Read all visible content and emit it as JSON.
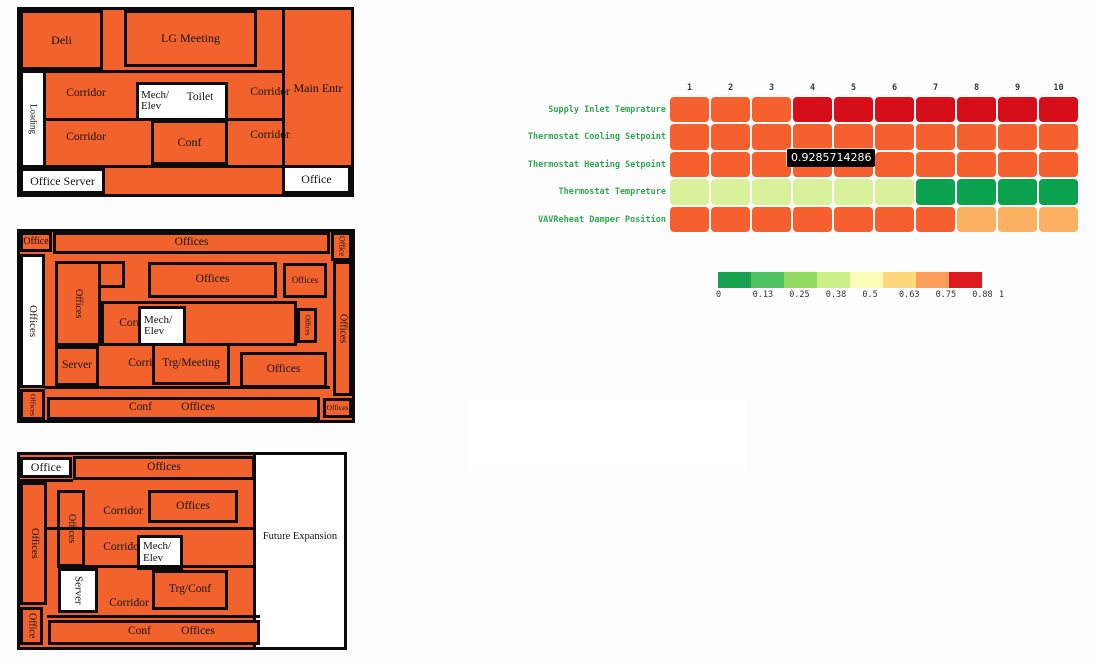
{
  "page": {
    "background": "#fdfdfd"
  },
  "chart_data": {
    "type": "heatmap",
    "title": "",
    "x": [
      1,
      2,
      3,
      4,
      5,
      6,
      7,
      8,
      9,
      10
    ],
    "rows": [
      "Supply Inlet Temprature",
      "Thermostat Cooling Setpoint",
      "Thermostat Heating Setpoint",
      "Thermostat Tempreture",
      "VAVReheat Damper Position"
    ],
    "values": [
      [
        0.93,
        0.93,
        0.93,
        1,
        1,
        1,
        1,
        1,
        1,
        1
      ],
      [
        0.93,
        0.93,
        0.93,
        0.93,
        0.93,
        0.93,
        0.93,
        0.93,
        0.93,
        0.93
      ],
      [
        0.9285714286,
        0.9285714286,
        0.9285714286,
        0.9285714286,
        0.9285714286,
        0.9285714286,
        0.9285714286,
        0.9285714286,
        0.9285714286,
        0.9285714286
      ],
      [
        0.3,
        0.3,
        0.3,
        0.3,
        0.3,
        0.3,
        0.05,
        0.05,
        0.05,
        0.05
      ],
      [
        0.93,
        0.93,
        0.93,
        0.93,
        0.93,
        0.93,
        0.93,
        0.75,
        0.75,
        0.75
      ]
    ],
    "zmin": 0,
    "zmax": 1,
    "colorscale": "RdYlGn reversed",
    "colorbar_ticks": [
      0,
      0.13,
      0.25,
      0.38,
      0.5,
      0.63,
      0.75,
      0.88,
      1
    ],
    "hovered_value": "0.9285714286",
    "legend_position": "below"
  },
  "heatmap": {
    "columns": [
      "1",
      "2",
      "3",
      "4",
      "5",
      "6",
      "7",
      "8",
      "9",
      "10"
    ],
    "rows": [
      {
        "label": "Supply Inlet Temprature",
        "cells": [
          "O",
          "O",
          "O",
          "R",
          "R",
          "R",
          "R",
          "R",
          "R",
          "R"
        ]
      },
      {
        "label": "Thermostat Cooling Setpoint",
        "cells": [
          "O",
          "O",
          "O",
          "O",
          "O",
          "O",
          "O",
          "O",
          "O",
          "O"
        ]
      },
      {
        "label": "Thermostat Heating Setpoint",
        "cells": [
          "O",
          "O",
          "O",
          "O",
          "O",
          "O",
          "O",
          "O",
          "O",
          "O"
        ]
      },
      {
        "label": "Thermostat Tempreture",
        "cells": [
          "LG",
          "LG",
          "LG",
          "LG",
          "LG",
          "LG",
          "DG",
          "DG",
          "DG",
          "DG"
        ]
      },
      {
        "label": "VAVReheat Damper Position",
        "cells": [
          "O",
          "O",
          "O",
          "O",
          "O",
          "O",
          "O",
          "LO",
          "LO",
          "LO"
        ]
      }
    ],
    "palette": {
      "O": "#F6602F",
      "R": "#D60E1A",
      "LG": "#D9F19B",
      "DG": "#0AA24F",
      "LO": "#FBB161"
    },
    "tooltip": {
      "text": "0.9285714286",
      "bg": "#000000",
      "fg": "#ffffff"
    },
    "label_color": "#2FA84F"
  },
  "legend": {
    "colors": [
      "#17A050",
      "#4FC263",
      "#96DB61",
      "#CDF189",
      "#FAFDB7",
      "#FDD87B",
      "#FB9C58",
      "#DC1A20"
    ],
    "ticks": [
      "0",
      "0.13",
      "0.25",
      "0.38",
      "0.5",
      "0.63",
      "0.75",
      "0.88",
      "1"
    ]
  },
  "floorplans": [
    {
      "name": "floor-1",
      "x": 17,
      "y": 7,
      "w": 337,
      "h": 190,
      "elements": [
        {
          "id": "wall-main-entr",
          "type": "wall",
          "x": 262,
          "y": 0,
          "w": 3,
          "h": 184
        },
        {
          "id": "wall-h1",
          "type": "wall",
          "x": 0,
          "y": 60,
          "w": 265,
          "h": 3
        },
        {
          "id": "wall-h2",
          "type": "wall",
          "x": 23,
          "y": 108,
          "w": 242,
          "h": 3
        },
        {
          "id": "wall-h3",
          "type": "wall",
          "x": 23,
          "y": 155,
          "w": 242,
          "h": 3
        },
        {
          "id": "room-deli",
          "type": "room",
          "label": "Deli",
          "x": 0,
          "y": 0,
          "w": 83,
          "h": 60,
          "fs": 12
        },
        {
          "id": "room-lg-meeting",
          "type": "room",
          "label": "LG Meeting",
          "x": 104,
          "y": 0,
          "w": 133,
          "h": 57,
          "fs": 12
        },
        {
          "id": "room-loading",
          "type": "white",
          "label": "Loading",
          "x": 0,
          "y": 60,
          "w": 26,
          "h": 98,
          "fs": 9,
          "vert": true
        },
        {
          "id": "room-mech-toilet",
          "type": "white",
          "label": "",
          "x": 116,
          "y": 72,
          "w": 92,
          "h": 39
        },
        {
          "id": "label-mech-elev",
          "type": "text",
          "label": "Mech/\nElev",
          "x": 118,
          "y": 75,
          "w": 40,
          "h": 32,
          "fs": 11,
          "align": "left"
        },
        {
          "id": "label-toilet",
          "type": "text",
          "label": "Toilet",
          "x": 155,
          "y": 80,
          "w": 50,
          "h": 16,
          "fs": 11.5
        },
        {
          "id": "room-conf",
          "type": "room",
          "label": "Conf",
          "x": 131,
          "y": 110,
          "w": 77,
          "h": 45,
          "fs": 12
        },
        {
          "id": "room-office-server",
          "type": "white",
          "label": "Office Server",
          "x": 0,
          "y": 158,
          "w": 85,
          "h": 26,
          "fs": 12
        },
        {
          "id": "room-office-br",
          "type": "white",
          "label": "Office",
          "x": 262,
          "y": 155,
          "w": 69,
          "h": 29,
          "fs": 12
        },
        {
          "id": "label-main-entr",
          "type": "text",
          "label": "Main Entr",
          "x": 265,
          "y": 70,
          "w": 66,
          "h": 16,
          "fs": 12
        },
        {
          "id": "label-corridor-1",
          "type": "text",
          "label": "Corridor",
          "x": 35,
          "y": 77,
          "w": 62,
          "h": 14,
          "fs": 11.5
        },
        {
          "id": "label-corridor-2",
          "type": "text",
          "label": "Corridor",
          "x": 219,
          "y": 76,
          "w": 62,
          "h": 14,
          "fs": 11.5
        },
        {
          "id": "label-corridor-3",
          "type": "text",
          "label": "Corridor",
          "x": 35,
          "y": 121,
          "w": 62,
          "h": 14,
          "fs": 11.5
        },
        {
          "id": "label-corridor-4",
          "type": "text",
          "label": "Corridor",
          "x": 219,
          "y": 119,
          "w": 62,
          "h": 14,
          "fs": 11.5
        }
      ]
    },
    {
      "name": "floor-2",
      "x": 17,
      "y": 229,
      "w": 338,
      "h": 194,
      "elements": [
        {
          "id": "wall-bottom",
          "type": "wall",
          "x": 25,
          "y": 154,
          "w": 285,
          "h": 3
        },
        {
          "id": "room-office-tl",
          "type": "room",
          "label": "Office",
          "x": 0,
          "y": 0,
          "w": 32,
          "h": 20,
          "fs": 10
        },
        {
          "id": "room-offices-top",
          "type": "room",
          "label": "Offices",
          "x": 33,
          "y": 0,
          "w": 277,
          "h": 22,
          "fs": 11.5
        },
        {
          "id": "room-office-tr",
          "type": "room",
          "label": "Office",
          "x": 311,
          "y": 0,
          "w": 21,
          "h": 29,
          "fs": 8,
          "vert": true
        },
        {
          "id": "room-offices-right",
          "type": "room",
          "label": "Offices",
          "x": 313,
          "y": 29,
          "w": 19,
          "h": 135,
          "fs": 10,
          "vert": true
        },
        {
          "id": "room-offices-left",
          "type": "white",
          "label": "Offices",
          "x": 0,
          "y": 22,
          "w": 25,
          "h": 134,
          "fs": 11,
          "vert": true
        },
        {
          "id": "room-offices-bl",
          "type": "room",
          "label": "Offices",
          "x": 0,
          "y": 157,
          "w": 25,
          "h": 31,
          "fs": 7.5,
          "vert": true
        },
        {
          "id": "room-offices-inner-top",
          "type": "room",
          "label": "",
          "x": 35,
          "y": 29,
          "w": 70,
          "h": 27
        },
        {
          "id": "room-offices-inner",
          "type": "room",
          "label": "Offices",
          "x": 35,
          "y": 29,
          "w": 46,
          "h": 85,
          "fs": 10,
          "vert": true
        },
        {
          "id": "room-corridor-block",
          "type": "room",
          "label": "",
          "x": 81,
          "y": 69,
          "w": 196,
          "h": 45
        },
        {
          "id": "label-corridor-1",
          "type": "text",
          "label": "Corridor",
          "x": 88,
          "y": 85,
          "w": 62,
          "h": 14,
          "fs": 11.5
        },
        {
          "id": "room-mech-elev",
          "type": "white",
          "label": "Mech/\nElev",
          "x": 118,
          "y": 74,
          "w": 48,
          "h": 40,
          "fs": 11,
          "align": "left"
        },
        {
          "id": "room-offices-small-mr",
          "type": "room",
          "label": "Offices",
          "x": 277,
          "y": 76,
          "w": 20,
          "h": 35,
          "fs": 7,
          "vert": true
        },
        {
          "id": "room-server",
          "type": "room",
          "label": "Server",
          "x": 35,
          "y": 114,
          "w": 44,
          "h": 40,
          "fs": 11.5
        },
        {
          "id": "label-corridor-2",
          "type": "text",
          "label": "Corridor",
          "x": 93,
          "y": 125,
          "w": 70,
          "h": 14,
          "fs": 11.5
        },
        {
          "id": "room-trg-meeting",
          "type": "room",
          "label": "Trg/Meeting",
          "x": 132,
          "y": 111,
          "w": 78,
          "h": 42,
          "fs": 11.5
        },
        {
          "id": "room-offices-cr",
          "type": "room",
          "label": "Offices",
          "x": 220,
          "y": 120,
          "w": 87,
          "h": 36,
          "fs": 11.5
        },
        {
          "id": "room-offices-big-top",
          "type": "room",
          "label": "Offices",
          "x": 128,
          "y": 30,
          "w": 129,
          "h": 36,
          "fs": 11.5
        },
        {
          "id": "room-offices-small-tr",
          "type": "room",
          "label": "Offices",
          "x": 263,
          "y": 31,
          "w": 44,
          "h": 35,
          "fs": 9
        },
        {
          "id": "room-bottom-bar",
          "type": "room",
          "label": "",
          "x": 27,
          "y": 165,
          "w": 273,
          "h": 23
        },
        {
          "id": "label-conf-b",
          "type": "text",
          "label": "Conf",
          "x": 98,
          "y": 168,
          "w": 45,
          "h": 16,
          "fs": 11.5
        },
        {
          "id": "label-offices-b",
          "type": "text",
          "label": "Offices",
          "x": 148,
          "y": 168,
          "w": 60,
          "h": 16,
          "fs": 11.5
        },
        {
          "id": "room-offices-br",
          "type": "room",
          "label": "Offices",
          "x": 303,
          "y": 166,
          "w": 29,
          "h": 20,
          "fs": 7.5
        }
      ]
    },
    {
      "name": "floor-3",
      "x": 17,
      "y": 452,
      "w": 330,
      "h": 198,
      "elements": [
        {
          "id": "area-future-expansion",
          "type": "white-plain",
          "label": "",
          "x": 235,
          "y": 0,
          "w": 89,
          "h": 192
        },
        {
          "id": "wall-future",
          "type": "wall",
          "x": 233,
          "y": 0,
          "w": 3,
          "h": 192
        },
        {
          "id": "label-future-expansion",
          "type": "text",
          "label": "Future Expansion",
          "x": 236,
          "y": 70,
          "w": 88,
          "h": 24,
          "fs": 10.5
        },
        {
          "id": "room-office-tl",
          "type": "white",
          "label": "Office",
          "x": 0,
          "y": 2,
          "w": 52,
          "h": 21,
          "fs": 12
        },
        {
          "id": "room-offices-top",
          "type": "room",
          "label": "Offices",
          "x": 53,
          "y": 1,
          "w": 182,
          "h": 24,
          "fs": 11.5
        },
        {
          "id": "wall-h0",
          "type": "wall",
          "x": 0,
          "y": 24,
          "w": 53,
          "h": 3
        },
        {
          "id": "room-offices-left",
          "type": "room",
          "label": "Offices",
          "x": 0,
          "y": 27,
          "w": 27,
          "h": 123,
          "fs": 10.5,
          "vert": true
        },
        {
          "id": "room-offices-inner",
          "type": "room",
          "label": "Offices",
          "x": 37,
          "y": 35,
          "w": 28,
          "h": 77,
          "fs": 10,
          "vert": true
        },
        {
          "id": "label-corridor-1",
          "type": "text",
          "label": "Corridor",
          "x": 72,
          "y": 50,
          "w": 62,
          "h": 14,
          "fs": 11.5
        },
        {
          "id": "room-offices-mid",
          "type": "room",
          "label": "Offices",
          "x": 128,
          "y": 35,
          "w": 90,
          "h": 33,
          "fs": 11.5
        },
        {
          "id": "wall-h1",
          "type": "wall",
          "x": 27,
          "y": 72,
          "w": 208,
          "h": 3
        },
        {
          "id": "label-corridor-2",
          "type": "text",
          "label": "Corridor",
          "x": 72,
          "y": 86,
          "w": 62,
          "h": 14,
          "fs": 11.5
        },
        {
          "id": "room-mech-elev",
          "type": "white",
          "label": "Mech/\nElev",
          "x": 117,
          "y": 80,
          "w": 46,
          "h": 35,
          "fs": 11,
          "align": "left"
        },
        {
          "id": "wall-h2",
          "type": "wall",
          "x": 37,
          "y": 110,
          "w": 198,
          "h": 3
        },
        {
          "id": "room-server",
          "type": "white",
          "label": "Server",
          "x": 38,
          "y": 113,
          "w": 40,
          "h": 45,
          "fs": 11,
          "vert": true
        },
        {
          "id": "room-trg-conf",
          "type": "room",
          "label": "Trg/Conf",
          "x": 132,
          "y": 115,
          "w": 76,
          "h": 40,
          "fs": 11.5
        },
        {
          "id": "label-corridor-3",
          "type": "text",
          "label": "Corridor",
          "x": 78,
          "y": 142,
          "w": 62,
          "h": 14,
          "fs": 11.5
        },
        {
          "id": "wall-h3",
          "type": "wall",
          "x": 27,
          "y": 160,
          "w": 213,
          "h": 3
        },
        {
          "id": "room-bottom-bar",
          "type": "room",
          "label": "",
          "x": 28,
          "y": 165,
          "w": 212,
          "h": 25
        },
        {
          "id": "label-conf-b",
          "type": "text",
          "label": "Conf",
          "x": 97,
          "y": 169,
          "w": 45,
          "h": 15,
          "fs": 11.5
        },
        {
          "id": "label-offices-b",
          "type": "text",
          "label": "Offices",
          "x": 148,
          "y": 169,
          "w": 60,
          "h": 15,
          "fs": 11.5
        },
        {
          "id": "room-office-bl",
          "type": "room",
          "label": "Office",
          "x": 0,
          "y": 152,
          "w": 23,
          "h": 38,
          "fs": 10,
          "vert": true
        }
      ]
    }
  ]
}
